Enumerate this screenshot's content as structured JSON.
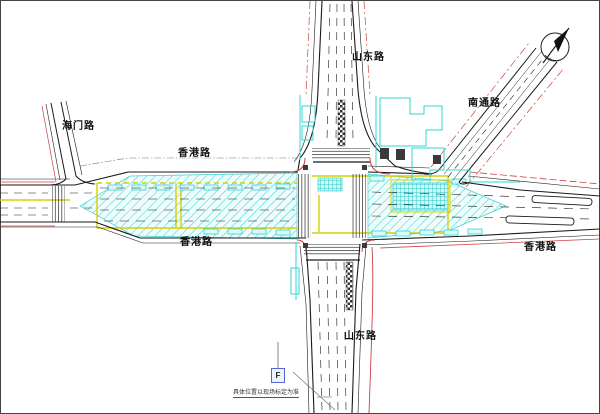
{
  "labels": {
    "haimen": "海门路",
    "hongkong_upper": "香港路",
    "shandong_top": "山东路",
    "nantong": "南通路",
    "hongkong_lower": "香港路",
    "hongkong_right": "香港路",
    "shandong_bottom": "山东路"
  },
  "annotation": {
    "note": "具体位置以现场标定为准",
    "symbol": "F"
  },
  "icons": {
    "compass": "north-arrow-compass"
  },
  "colors": {
    "hatch_cyan": "#35cfcf",
    "building_cyan": "#2fd4d4",
    "boundary_red": "#cc4040",
    "marking_yellow": "#ddd000",
    "line_black": "#1a1a1a",
    "background": "#ffffff"
  }
}
